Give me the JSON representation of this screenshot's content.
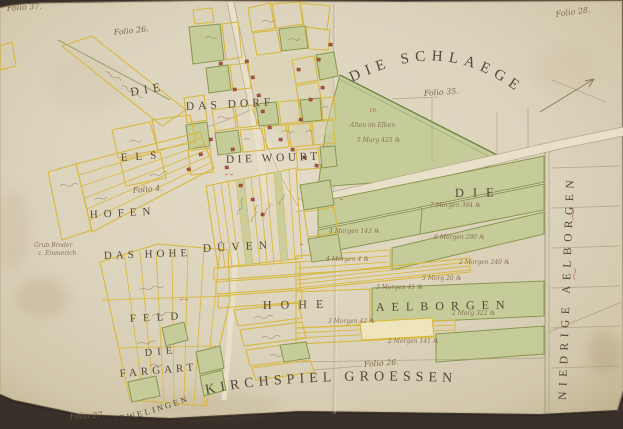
{
  "page": {
    "width": 623,
    "height": 429,
    "kind": "scanned manuscript cadastral map"
  },
  "colors": {
    "backdrop": "#39302a",
    "paper": "#dcd3bd",
    "parcel_yellow": "#d8b83e",
    "field_green_fill": "#c6cc99",
    "field_green_stroke": "#87974f",
    "ink_labels": "#443a2e",
    "ink_cursive": "#74603f",
    "ink_red": "#a6543e",
    "house_red": "#ae5340"
  },
  "map": {
    "region_labels": [
      {
        "name": "label-die-nw",
        "text": "DIE",
        "x": 131,
        "y": 96,
        "size": 12,
        "ls": 5,
        "rot": -10
      },
      {
        "name": "label-das-dorf",
        "text": "DAS  DORF",
        "x": 186,
        "y": 110,
        "size": 11.5,
        "ls": 4,
        "rot": -3
      },
      {
        "name": "label-els",
        "text": "ELS",
        "x": 121,
        "y": 161,
        "size": 11,
        "ls": 8,
        "rot": -4
      },
      {
        "name": "label-die-wourt",
        "text": "DIE  WOURT",
        "x": 226,
        "y": 163,
        "size": 11.5,
        "ls": 3.5,
        "rot": -2
      },
      {
        "name": "label-hofen",
        "text": "HOFEN",
        "x": 90,
        "y": 218,
        "size": 11,
        "ls": 6,
        "rot": -3
      },
      {
        "name": "label-das-hohe",
        "text": "DAS  HOHE",
        "x": 104,
        "y": 259,
        "size": 11,
        "ls": 4,
        "rot": -2
      },
      {
        "name": "label-duven",
        "text": "DÜVEN",
        "x": 203,
        "y": 252,
        "size": 11.5,
        "ls": 6,
        "rot": -3
      },
      {
        "name": "label-feld",
        "text": "FELD",
        "x": 130,
        "y": 322,
        "size": 11,
        "ls": 7,
        "rot": -3
      },
      {
        "name": "label-die-sw",
        "text": "DIE",
        "x": 145,
        "y": 356,
        "size": 10.5,
        "ls": 5,
        "rot": -5
      },
      {
        "name": "label-fargart",
        "text": "FARGART",
        "x": 120,
        "y": 377,
        "size": 11,
        "ls": 4,
        "rot": -5
      },
      {
        "name": "label-hohe-mid",
        "text": "HOHE",
        "x": 263,
        "y": 309,
        "size": 12,
        "ls": 9,
        "rot": -1
      },
      {
        "name": "label-aelborgen-mid",
        "text": "AELBORGEN",
        "x": 376,
        "y": 311,
        "size": 12,
        "ls": 7,
        "rot": -1
      },
      {
        "name": "label-die-east",
        "text": "DIE",
        "x": 455,
        "y": 197,
        "size": 12.5,
        "ls": 9,
        "rot": -1
      },
      {
        "name": "label-niedrige-aelborgen",
        "text": "NIEDRIGE  AELBORGEN",
        "x": 566,
        "y": 400,
        "size": 11.5,
        "ls": 5.5,
        "rot": -88
      }
    ],
    "curved_labels": [
      {
        "name": "label-die-schlaege",
        "text": "DIE  SCHLAEGE",
        "path": "p-schlaege",
        "size": 15,
        "ls": 6,
        "off": "2%"
      },
      {
        "name": "label-kirchspiel-groessen",
        "text": "KIRCHSPIEL   GROESSEN",
        "path": "p-kirch",
        "size": 14,
        "ls": 5,
        "off": "1%"
      },
      {
        "name": "label-giewelingen",
        "text": "GIEWELINGEN",
        "path": "p-giewe",
        "size": 8.5,
        "ls": 2.5,
        "off": "5%"
      }
    ],
    "folio_labels": [
      {
        "name": "folio-37",
        "text": "Folio 37.",
        "x": 7,
        "y": 11,
        "rot": -4
      },
      {
        "name": "folio-26-top",
        "text": "Folio 26.",
        "x": 114,
        "y": 35,
        "rot": -6
      },
      {
        "name": "folio-28",
        "text": "Folio 28.",
        "x": 556,
        "y": 17,
        "rot": -8
      },
      {
        "name": "folio-35",
        "text": "Folio 35.",
        "x": 424,
        "y": 96,
        "rot": -4
      },
      {
        "name": "folio-4",
        "text": "Folio 4.",
        "x": 133,
        "y": 193,
        "rot": -5
      },
      {
        "name": "folio-26-mid",
        "text": "Folio 26.",
        "x": 364,
        "y": 367,
        "rot": -4
      },
      {
        "name": "folio-27",
        "text": "Folio 27.",
        "x": 70,
        "y": 419,
        "rot": -3
      }
    ],
    "annotations": [
      {
        "text": "16.",
        "x": 369,
        "y": 112,
        "red": true,
        "size": 5.5
      },
      {
        "text": "Alten im Elben",
        "x": 350,
        "y": 127
      },
      {
        "text": "5 Morg 425 ℞",
        "x": 357,
        "y": 142
      },
      {
        "text": "7 Morgen 364 ℞",
        "x": 430,
        "y": 207
      },
      {
        "text": "4 Morgen 143 ℞",
        "x": 329,
        "y": 233
      },
      {
        "text": "6 Morgen 280 ℞",
        "x": 434,
        "y": 239
      },
      {
        "text": "4 Morgen 4 ℞",
        "x": 326,
        "y": 261
      },
      {
        "text": "2 Morgen 240 ℞",
        "x": 459,
        "y": 264
      },
      {
        "text": "5 Morg 20 ℞",
        "x": 422,
        "y": 280
      },
      {
        "text": "3 Morgen 41 ℞",
        "x": 376,
        "y": 289
      },
      {
        "text": "2 Morg 322 ℞",
        "x": 452,
        "y": 315
      },
      {
        "text": "3 Morgen 42 ℞",
        "x": 328,
        "y": 323
      },
      {
        "text": "2 Morgen 141 ℞",
        "x": 388,
        "y": 343
      },
      {
        "text": "Grub Broder",
        "x": 34,
        "y": 247
      },
      {
        "text": "z. Emmerich",
        "x": 38,
        "y": 255
      }
    ]
  }
}
